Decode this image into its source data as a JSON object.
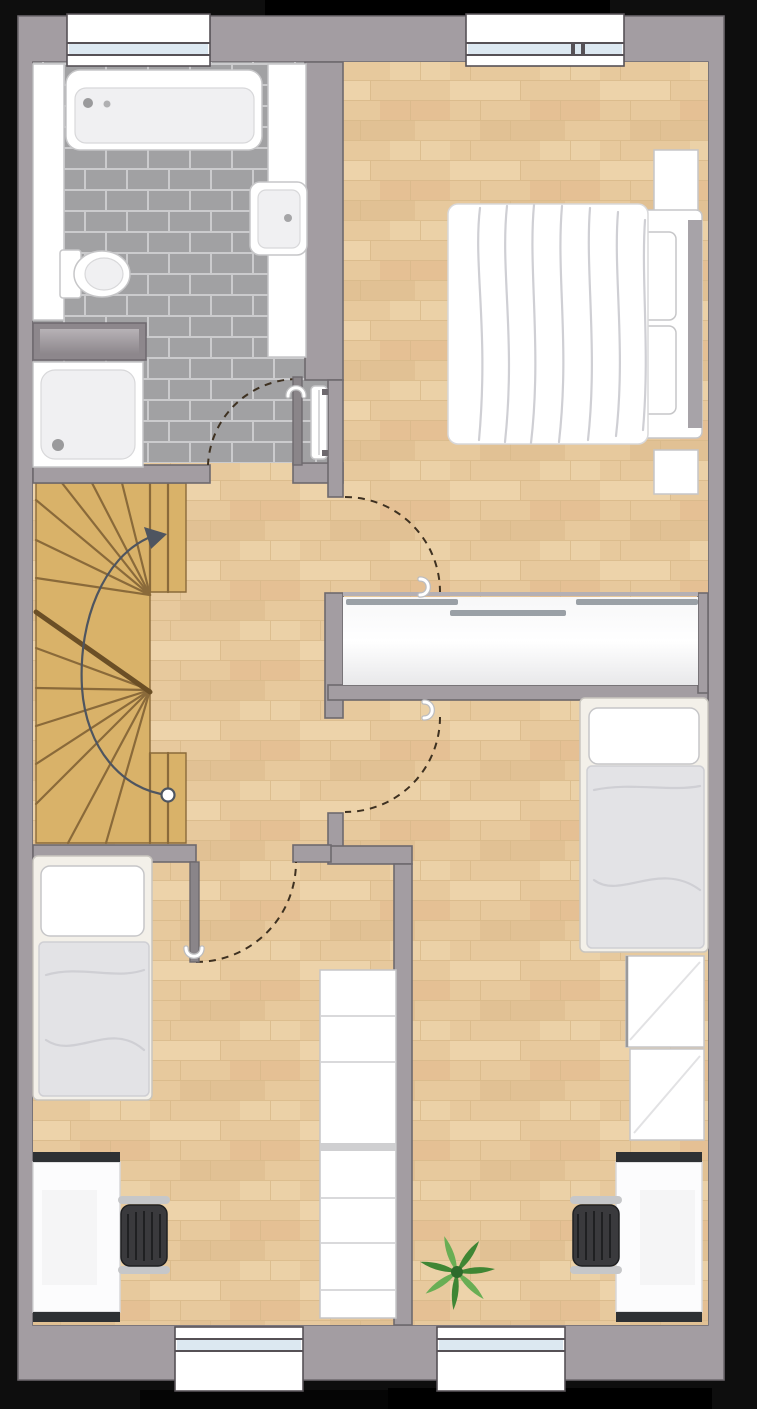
{
  "meta": {
    "kind": "floor-plan",
    "view": "top-down 2d render",
    "floor_label": "upper floor",
    "visible_text": "none"
  },
  "palette": {
    "bg_black": "#0e0e0e",
    "bg_black2": "#000000",
    "wall_fill": "#a39da2",
    "wall_line": "#6e696e",
    "wall_soft": "#b5b0b4",
    "wood_base": "#e7c99d",
    "wood_stripe1": "#d9b98a",
    "wood_stripe2": "#f0d9b1",
    "wood_knot": "#dca87e",
    "tile_fill": "#a1a1a3",
    "tile_grout": "#cbcbcd",
    "stair_fill": "#d9b269",
    "stair_line": "#8a6a3a",
    "stair_diag": "#6b4f26",
    "white": "#ffffff",
    "soft_gray": "#f0f0f2",
    "fixture_line": "#c6c6c8",
    "fixture_line2": "#d8d8da",
    "textile": "#e3e3e6",
    "textile_line": "#cfcfd4",
    "bedframe_cream": "#f3f0e9",
    "bedframe_line": "#c9c6bf",
    "headboard": "#a7a3a8",
    "desk_bar": "#2e3134",
    "chair_seat": "#3a3a3d",
    "chair_slat": "#1f2022",
    "chair_arm": "#c6c7c9",
    "plant_dark": "#3f8634",
    "plant_light": "#69ae54",
    "plant_core": "#2e6b2b",
    "arc_dash": "#3e3121",
    "guide": "#4e5560",
    "glass": "#dce8f1",
    "frame_dark": "#565156",
    "leaf_fill": "#8a8589",
    "track": "#9aa0a6",
    "handle_shadow": "#bdbdbf",
    "cabinet_dark": "#8d878c",
    "cabinet_light": "#b7b2b6"
  },
  "rooms": [
    {
      "id": "bathroom",
      "floor": "grey-tile",
      "fixtures": [
        "bathtub",
        "vanity-counter-left",
        "vanity-counter-right",
        "washbasin",
        "toilet",
        "wall-cabinet",
        "shower",
        "towel-radiator"
      ]
    },
    {
      "id": "landing-hall",
      "floor": "wood",
      "fixtures": [
        "winder-staircase"
      ]
    },
    {
      "id": "master-bedroom",
      "floor": "wood",
      "fixtures": [
        "double-bed",
        "nightstand-top",
        "nightstand-bottom",
        "sliding-door-closet"
      ]
    },
    {
      "id": "room-bottom-left",
      "floor": "wood",
      "fixtures": [
        "single-bed",
        "desk",
        "office-chair",
        "shelf-unit"
      ]
    },
    {
      "id": "room-bottom-right",
      "floor": "wood",
      "fixtures": [
        "single-bed",
        "wardrobe",
        "desk",
        "office-chair",
        "plant"
      ]
    }
  ],
  "doors": [
    {
      "id": "bathroom-door",
      "swing": "into bathroom",
      "leaf_shown": true,
      "handle_icon": true
    },
    {
      "id": "master-bedroom-door",
      "swing": "into bedroom",
      "leaf_shown": false,
      "handle_icon": true
    },
    {
      "id": "room-bottom-right-door",
      "swing": "into room",
      "leaf_shown": false,
      "handle_icon": true
    },
    {
      "id": "room-bottom-left-door",
      "swing": "into room",
      "leaf_shown": true,
      "handle_icon": true
    }
  ],
  "windows": [
    {
      "id": "window-top-left",
      "wall": "north",
      "panes": 1
    },
    {
      "id": "window-top-right",
      "wall": "north",
      "panes": 2
    },
    {
      "id": "window-bottom-left",
      "wall": "south",
      "panes": 1
    },
    {
      "id": "window-bottom-right",
      "wall": "south",
      "panes": 1
    }
  ],
  "stairs": {
    "type": "double-winder",
    "direction_marker": "circle-start to arrow-end (up)",
    "treads_visible": 16
  }
}
